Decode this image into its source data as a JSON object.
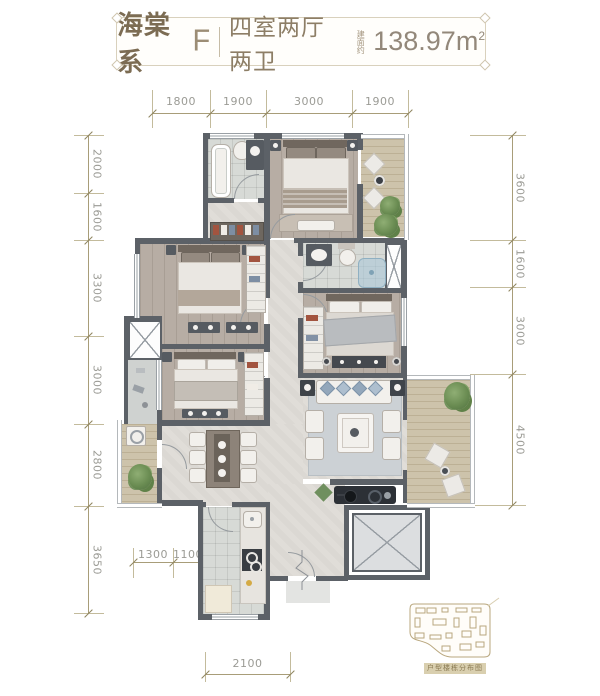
{
  "title": {
    "series": "海棠系",
    "unit_code": "F",
    "layout": "四室两厅两卫",
    "area_prefix": "建面约",
    "area_value": "138.97",
    "area_unit": "m",
    "area_exp": "2"
  },
  "dimensions": {
    "top": [
      "1800",
      "1900",
      "3000",
      "1900"
    ],
    "left": [
      "2000",
      "1600",
      "3300",
      "3000",
      "2800",
      "3650"
    ],
    "right": [
      "3600",
      "1600",
      "3000",
      "4500"
    ],
    "bottom_upper": [
      "1300",
      "1100"
    ],
    "bottom": [
      "2100"
    ]
  },
  "inset": {
    "caption": "户型楼栋分布图"
  },
  "colors": {
    "title_text": "#7c6c53",
    "title_secondary": "#8d7e66",
    "dim_line": "#a89d79",
    "dim_text": "#9b9b95",
    "wall": "#5c6167",
    "wood_floor": "#b7ada4",
    "balcony_wood": "#cdc3ab",
    "marble_floor": "#e0ddd8",
    "tile_floor": "#d7dad6",
    "plant_green": "#6a8c52",
    "closet_red": "#a2543f",
    "pillow_blue": "#93a7bb",
    "inset_tan": "#b9a77e"
  }
}
